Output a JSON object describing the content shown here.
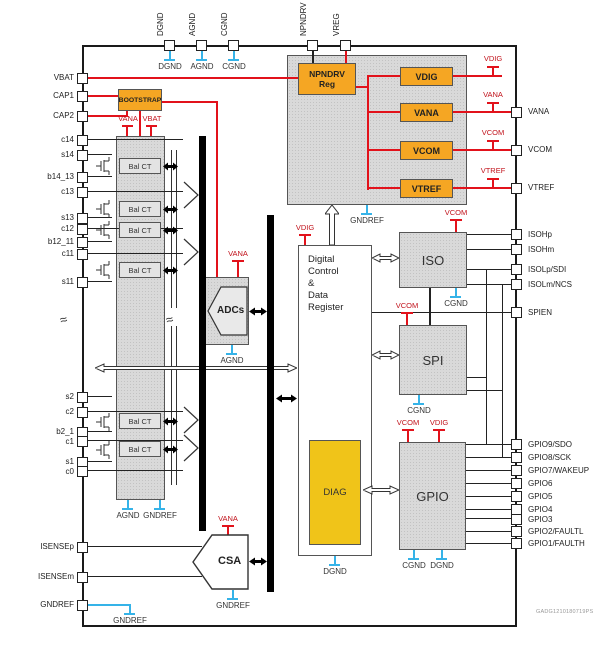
{
  "pins": {
    "top": [
      "DGND",
      "AGND",
      "CGND",
      "NPNDRV",
      "VREG"
    ],
    "left": [
      "VBAT",
      "CAP1",
      "CAP2",
      "c14",
      "s14",
      "b14_13",
      "c13",
      "s13",
      "c12",
      "b12_11",
      "c11",
      "s11",
      "s2",
      "c2",
      "b2_1",
      "c1",
      "s1",
      "c0",
      "ISENSEp",
      "ISENSEm",
      "GNDREF"
    ],
    "right": [
      "VANA",
      "VCOM",
      "VTREF",
      "ISOHp",
      "ISOHm",
      "ISOLp/SDI",
      "ISOLm/NCS",
      "SPIEN",
      "GPIO9/SDO",
      "GPIO8/SCK",
      "GPIO7/WAKEUP",
      "GPIO6",
      "GPIO5",
      "GPIO4",
      "GPIO3",
      "GPIO2/FAULTL",
      "GPIO1/FAULTH"
    ]
  },
  "blocks": {
    "bootstrap": "BOOTSTRAP",
    "npndrv_line1": "NPNDRV",
    "npndrv_line2": "Reg",
    "reg_vdig": "VDIG",
    "reg_vana": "VANA",
    "reg_vcom": "VCOM",
    "reg_vtref": "VTREF",
    "bal_ct": "Bal CT",
    "adcs": "ADCs",
    "digital_lines": [
      "Digital",
      "Control",
      "&",
      "Data",
      "Register"
    ],
    "diag": "DIAG",
    "iso": "ISO",
    "spi": "SPI",
    "gpio": "GPIO",
    "csa": "CSA"
  },
  "rail_labels": {
    "vdig": "VDIG",
    "vana": "VANA",
    "vbat": "VBAT",
    "vcom": "VCOM",
    "vtref": "VTREF"
  },
  "ground_labels": {
    "dgnd": "DGND",
    "agnd": "AGND",
    "cgnd": "CGND",
    "gndref": "GNDREF"
  },
  "colors": {
    "orange": "#F5A623",
    "gold": "#F0C419",
    "red": "#E2121B",
    "cyan": "#35B3E8",
    "block_gray": "#D9D9D9"
  },
  "footer_code": "GADG1210180719PS"
}
